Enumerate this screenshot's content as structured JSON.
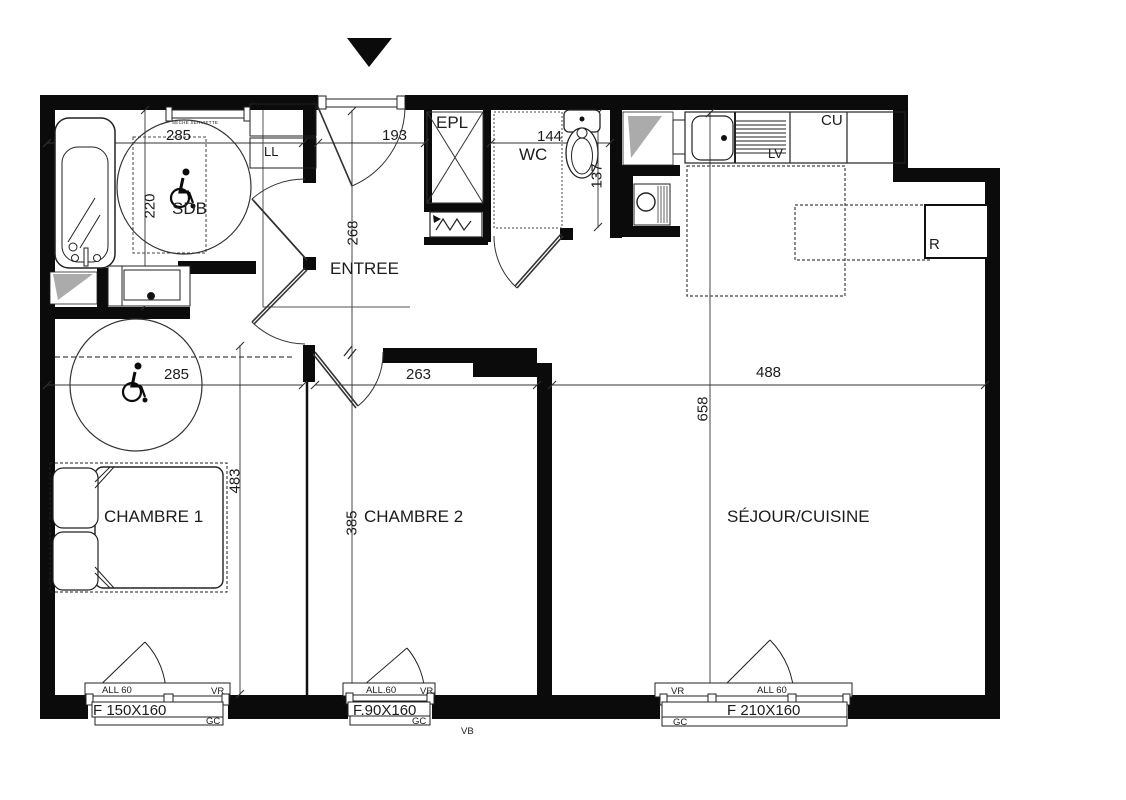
{
  "plan": {
    "rooms": {
      "sdb": {
        "label": "SDB",
        "width": "285",
        "height": "220"
      },
      "entree": {
        "label": "ENTREE",
        "width": "193",
        "height": "268"
      },
      "epl": {
        "label": "EPL"
      },
      "wc": {
        "label": "WC",
        "width": "144",
        "height": "137"
      },
      "chambre1": {
        "label": "CHAMBRE 1",
        "width": "285",
        "height": "483"
      },
      "chambre2": {
        "label": "CHAMBRE 2",
        "width": "263",
        "height": "385"
      },
      "sejour": {
        "label": "SÉJOUR/CUISINE",
        "width": "488",
        "height": "658"
      }
    },
    "fixtures": {
      "washing_machine": "LL",
      "dishwasher": "LV",
      "kitchen_unit": "CU",
      "fridge": "R",
      "towel_dryer": "SECHE SERVIETTE"
    },
    "windows": [
      {
        "frame": "F 150X160",
        "sill": "ALL 60",
        "shutter": "VR",
        "tag": "GC"
      },
      {
        "frame": "F.90X160",
        "sill": "ALL.60",
        "shutter": "VR",
        "tag": "GC"
      },
      {
        "frame": "F 210X160",
        "sill": "ALL 60",
        "shutter": "VR",
        "tag": "GC"
      }
    ],
    "notes": {
      "vb": "VB"
    },
    "icons": {
      "wheelchair": "wheelchair-symbol",
      "entrance_marker": "triangle-down"
    },
    "colors": {
      "wall": "#0b0b0b",
      "line": "#2a2a2a",
      "gray": "#ababab"
    }
  }
}
